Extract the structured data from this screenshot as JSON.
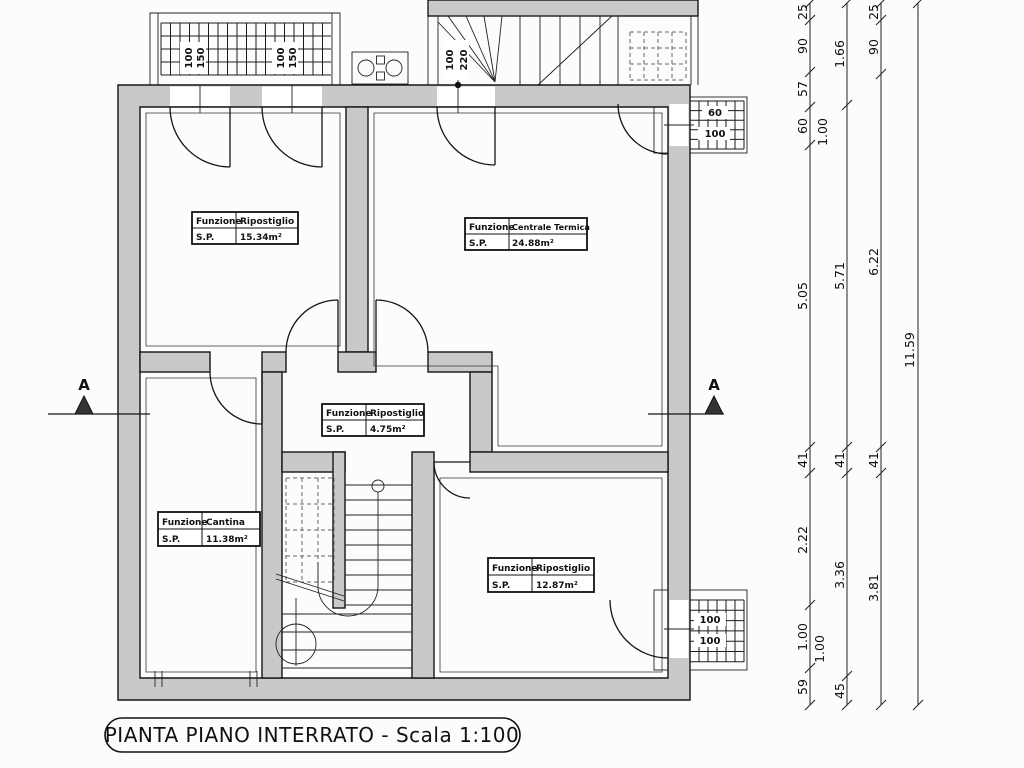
{
  "title": "PIANTA PIANO INTERRATO - Scala 1:100",
  "section_label": "A",
  "labels": {
    "funzione": "Funzione",
    "sp": "S.P."
  },
  "rooms": [
    {
      "name": "Ripostiglio",
      "area": "15.34m²"
    },
    {
      "name": "Centrale Termica",
      "area": "24.88m²"
    },
    {
      "name": "Ripostiglio",
      "area": "4.75m²"
    },
    {
      "name": "Cantina",
      "area": "11.38m²"
    },
    {
      "name": "Ripostiglio",
      "area": "12.87m²"
    }
  ],
  "openings": {
    "grate_left": {
      "w": "100",
      "h": "150"
    },
    "grate_right": {
      "w": "100",
      "h": "150"
    },
    "stair_door": {
      "w": "100",
      "h": "220"
    },
    "window_top_right": {
      "w": "60",
      "h": "100"
    },
    "window_bottom_right": {
      "w": "100",
      "h": "100"
    }
  },
  "dims": {
    "c1": [
      "25",
      "90",
      "57",
      "60",
      "1.00",
      "5.05",
      "41",
      "2.22",
      "1.00",
      "1.00",
      "59"
    ],
    "c2": [
      "1.66",
      "5.71",
      "41",
      "3.36",
      "45"
    ],
    "c3": [
      "25",
      "90",
      "6.22",
      "41",
      "3.81"
    ],
    "c4": [
      "11.59"
    ]
  }
}
